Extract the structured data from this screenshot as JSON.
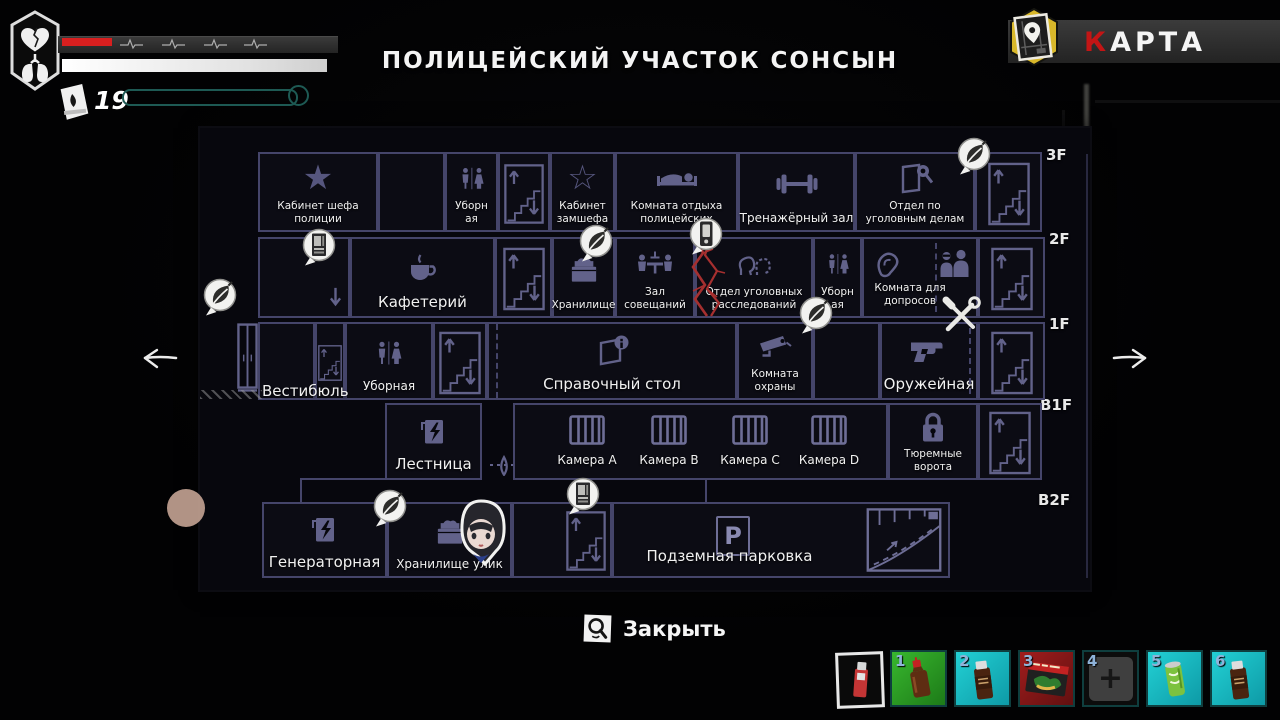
{
  "hud": {
    "location_title": "ПОЛИЦЕЙСКИЙ УЧАСТОК СОНСЫН",
    "map_title": {
      "first": "К",
      "rest": "АРТА"
    },
    "matches_count": "19",
    "close_label": "Закрыть",
    "health_badge_icon": "heart-and-lungs",
    "matches_icon": "matchbook"
  },
  "glyphs": {
    "star_filled": "★",
    "star_outline": "☆",
    "plus": "+"
  },
  "colors": {
    "health_red": "#d81f1f",
    "karta_red": "#c31515",
    "map_chip_yellow": "#d9b82a",
    "slot_green": "#2fae27",
    "slot_cyan": "#17c3c9",
    "slot_red": "#8f1717",
    "map_wall": "#45456a"
  },
  "map": {
    "floors": [
      {
        "tag": "3F",
        "rooms": [
          {
            "label": "Кабинет шефа полиции",
            "icon": "star-filled"
          },
          {
            "label": "",
            "icon": ""
          },
          {
            "label": "Уборн ая",
            "icon": "restroom"
          },
          {
            "label": "",
            "icon": "stairs"
          },
          {
            "label": "Кабинет замшефа",
            "icon": "star-outline"
          },
          {
            "label": "Комната отдыха полицейских",
            "icon": "bed"
          },
          {
            "label": "Тренажёрный зал",
            "icon": "dumbbell"
          },
          {
            "label": "Отдел по уголовным делам",
            "icon": "case-file-magnifier"
          },
          {
            "label": "",
            "icon": "stairs"
          }
        ]
      },
      {
        "tag": "2F",
        "rooms": [
          {
            "label": "",
            "icon": "exit-down-arrow"
          },
          {
            "label": "Кафетерий",
            "icon": "coffee-cup"
          },
          {
            "label": "",
            "icon": "stairs"
          },
          {
            "label": "Хранилище",
            "icon": "storage-box"
          },
          {
            "label": "Зал совещаний",
            "icon": "meeting-table"
          },
          {
            "label": "Отдел уголовных расследований",
            "icon": "suspect-heads"
          },
          {
            "label": "Уборн ая",
            "icon": "restroom"
          },
          {
            "label": "Комната для допросов",
            "icon": "ear-and-interrogators"
          },
          {
            "label": "",
            "icon": "stairs"
          }
        ]
      },
      {
        "tag": "1F",
        "rooms": [
          {
            "label": "",
            "icon": ""
          },
          {
            "label": "",
            "icon": "stairs"
          },
          {
            "label": "Уборная",
            "icon": "restroom"
          },
          {
            "label": "",
            "icon": "stairs"
          },
          {
            "label": "Справочный стол",
            "icon": "info-desk"
          },
          {
            "label": "Комната охраны",
            "icon": "cctv-camera"
          },
          {
            "label": "",
            "icon": ""
          },
          {
            "label": "Оружейная",
            "icon": "pistol"
          },
          {
            "label": "",
            "icon": "stairs"
          }
        ]
      },
      {
        "tag": "B1F",
        "rooms": [
          {
            "label": "Лестница",
            "icon": "breaker-panel"
          },
          {
            "label": "",
            "icon": "jail-bars"
          },
          {
            "label": "Тюремные ворота",
            "icon": "padlock"
          },
          {
            "label": "",
            "icon": "stairs"
          }
        ]
      },
      {
        "tag": "B2F",
        "rooms": [
          {
            "label": "Генераторная",
            "icon": "breaker-panel"
          },
          {
            "label": "Хранилище улик",
            "icon": "storage-box"
          },
          {
            "label": "",
            "icon": "stairs"
          },
          {
            "label": "Подземная парковка",
            "icon": "parking-sign-and-ramp"
          }
        ]
      }
    ],
    "cells": [
      "Камера A",
      "Камера B",
      "Камера C",
      "Камера D"
    ],
    "vestibule_label": "Вестибюль",
    "parking_sign": "P",
    "markers": [
      "save-point-leaf",
      "vending-machine",
      "save-point-leaf",
      "phone",
      "save-point-leaf",
      "save-point-leaf",
      "workbench-tools",
      "save-point-leaf",
      "vending-machine"
    ],
    "player_marker": "girl-avatar",
    "hazard": "red-cracks"
  },
  "inventory": {
    "equipped_item": "red-lighter",
    "slots": [
      {
        "num": "1",
        "item": "medicine-bottle",
        "bg": "green"
      },
      {
        "num": "2",
        "item": "tonic-drink-bottle",
        "bg": "cyan"
      },
      {
        "num": "3",
        "item": "snack-pack",
        "bg": "red"
      },
      {
        "num": "4",
        "item": "empty",
        "bg": "none"
      },
      {
        "num": "5",
        "item": "green-can-drink",
        "bg": "cyan"
      },
      {
        "num": "6",
        "item": "tonic-drink-bottle",
        "bg": "cyan"
      }
    ]
  }
}
